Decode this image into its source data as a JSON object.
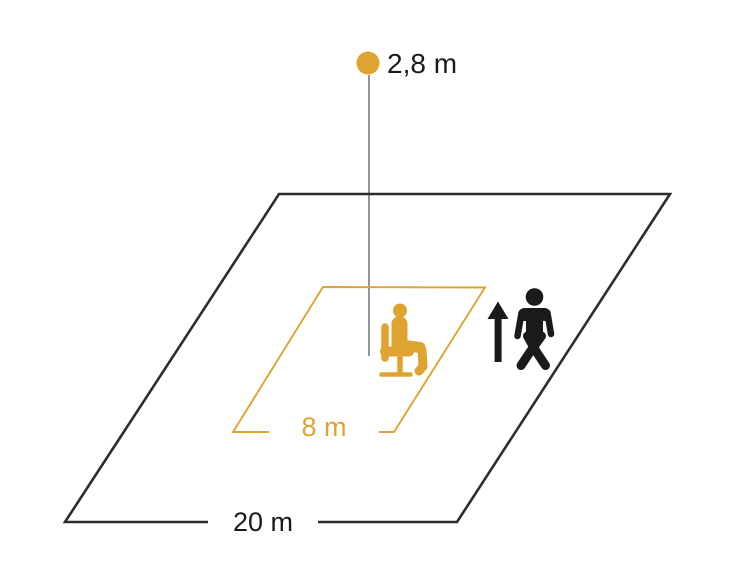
{
  "diagram": {
    "type": "sensor-detection-range-diagram",
    "labels": {
      "mounting_height": "2,8 m",
      "walking_range": "20 m",
      "presence_range": "8 m"
    },
    "colors": {
      "orange": "#DFA330",
      "black": "#1A1A1A",
      "outline_black": "#2D2D2D",
      "drop_line_gray": "#4D4D4D",
      "background": "#FFFFFF"
    },
    "icons": {
      "sensor": "sensor-dot",
      "seated": "seated-person-icon",
      "walking": "walking-person-icon",
      "direction": "up-arrow-icon"
    },
    "areas": {
      "outer": "walking-detection-area",
      "inner": "seated-presence-area"
    }
  }
}
